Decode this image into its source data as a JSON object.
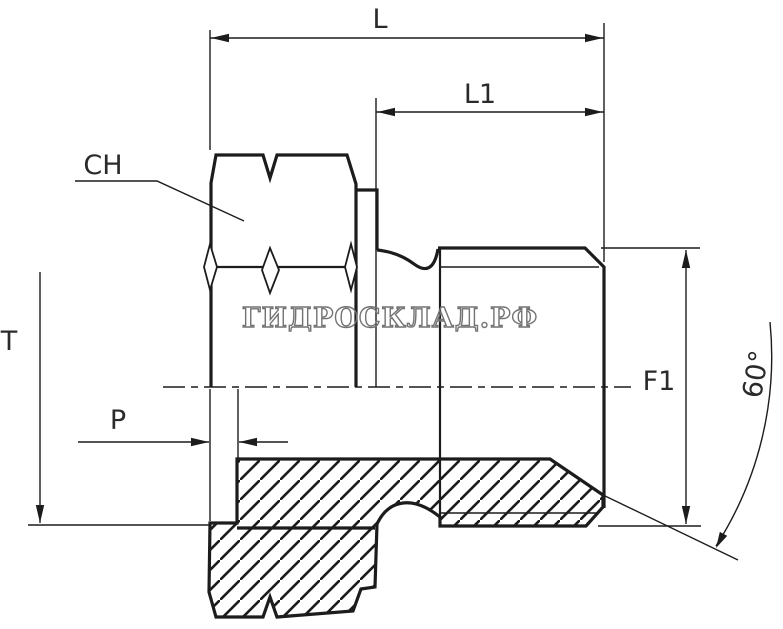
{
  "drawing": {
    "type": "technical-drawing-hydraulic-fitting-half-section",
    "watermark_text": "ГИДРОСКЛАД.РФ",
    "labels": {
      "overall_length": "L",
      "thread_length": "L1",
      "hex_size": "CH",
      "depth_t": "T",
      "pitch_p": "P",
      "thread_diameter": "F1",
      "cone_angle": "60°"
    },
    "colors": {
      "line": "#1c1c1c",
      "background": "#ffffff",
      "watermark": "#737373"
    }
  }
}
